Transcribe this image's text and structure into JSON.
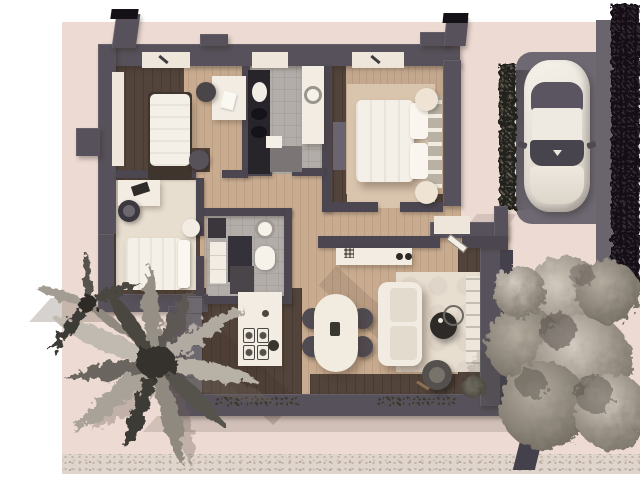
{
  "scene": {
    "type": "3d-aerial-floor-plan-render",
    "description": "Top-down 3D rendering of a single-storey home with driveway, parked car, palm tree, garden shrub and gravel path",
    "palette": {
      "background": "#ffffff",
      "ground": "#eddbd3",
      "wall": "#56515a",
      "wall_inner": "#4b4650",
      "chimney_cap": "#141216",
      "wood_light": "#c9ac90",
      "wood_dark": "#52443a",
      "tile_gray": "#b2ada8",
      "rug_cream": "#e8ded0",
      "rug_beige": "#d9c5ae",
      "furniture_white": "#f2ece2",
      "accent_dark": "#2c2927",
      "gravel": "#e0d5cc",
      "hedge_dark": "#131116",
      "car_body": "#f0ebe3",
      "car_glass": "#5a5560"
    },
    "labels": {
      "house": "house floor plan",
      "bedroom_1": "bedroom with single bed and desk",
      "bathroom_1": "main bathroom with double vanity, basin counter and shower",
      "master_bedroom": "master bedroom with double bed",
      "bedroom_2": "second bedroom with bed, desk and office chair",
      "bathroom_2": "central bathroom with basin, toilet and shower",
      "kitchen": "kitchen with wall counter and cooktop island",
      "dining": "dining area with oval table and four chairs",
      "living": "living room with sofa, coffee tables, armchair and rug",
      "entry": "entry with wardrobe and open door",
      "car": "white car parked on driveway pad",
      "hedge": "tall dark hedge along right edge",
      "plant_strip": "planted hedge strip beside parking",
      "palm": "palm tree at lower left",
      "tree": "garden shrub at lower right",
      "gravel": "gravel path along bottom"
    },
    "rooms": [
      {
        "name": "bedroom-1",
        "furniture": [
          "single-bed",
          "desk",
          "desk-chair",
          "pouf",
          "wardrobe-niche",
          "window-seat"
        ]
      },
      {
        "name": "bathroom-1",
        "furniture": [
          "dark-vanity",
          "twin-sinks",
          "round-basin-counter",
          "shower",
          "bath-mat"
        ]
      },
      {
        "name": "master-bedroom",
        "furniture": [
          "double-bed",
          "pillows",
          "headboard",
          "area-rug",
          "round-poufs",
          "wardrobe",
          "window-seat"
        ]
      },
      {
        "name": "bedroom-2",
        "furniture": [
          "bed",
          "desk",
          "laptop",
          "office-chair",
          "round-side-table",
          "area-rug"
        ]
      },
      {
        "name": "bathroom-2",
        "furniture": [
          "basin",
          "toilet",
          "vanity",
          "shower",
          "cabinet"
        ]
      },
      {
        "name": "kitchen",
        "furniture": [
          "wall-counter",
          "island",
          "cooktop",
          "fruit-bowl"
        ]
      },
      {
        "name": "dining-area",
        "furniture": [
          "oval-table",
          "chair",
          "chair",
          "chair",
          "chair"
        ]
      },
      {
        "name": "living-room",
        "furniture": [
          "sofa",
          "coffee-table-set",
          "armchair",
          "area-rug",
          "credenza",
          "media-shelf",
          "floor-plant",
          "window-planter"
        ]
      },
      {
        "name": "entry",
        "furniture": [
          "closet",
          "open-door"
        ]
      }
    ],
    "outdoor": [
      "driveway-pad",
      "car",
      "hedge-strip",
      "tall-hedge",
      "gravel-path",
      "palm-tree",
      "shrub-tree",
      "window-planters"
    ]
  }
}
